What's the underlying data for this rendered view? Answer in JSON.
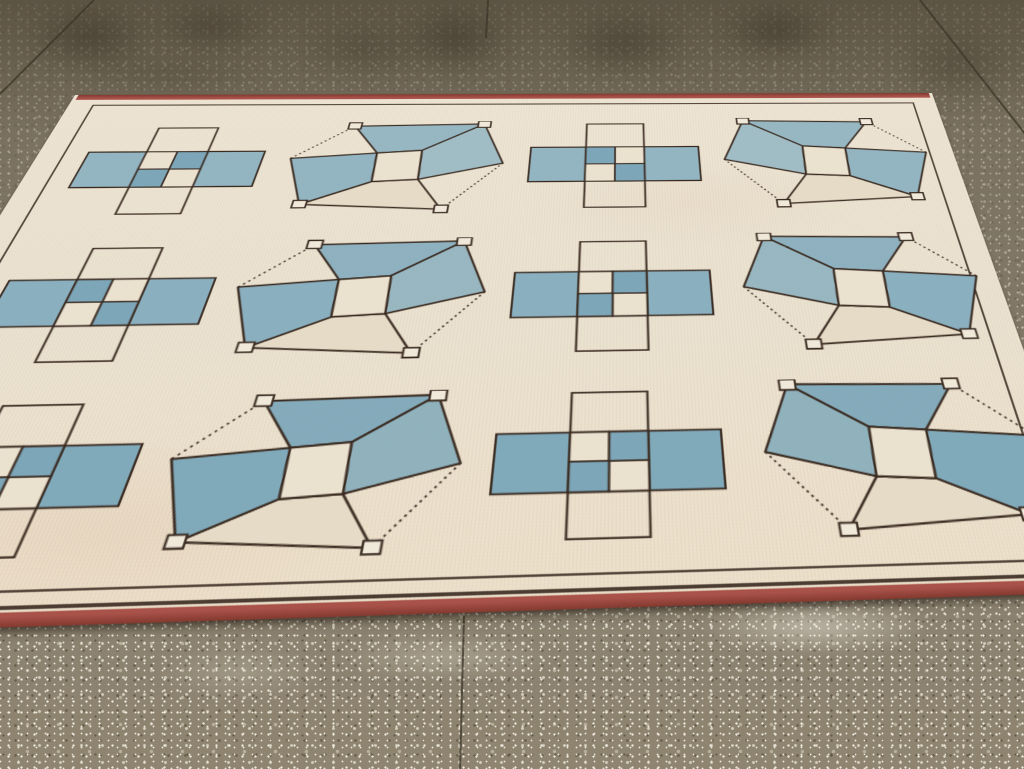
{
  "meta": {
    "type": "photograph",
    "subject": "Vintage cream rug with blue geometric cube and checkerboard motifs lying on a speckled concrete floor"
  },
  "palette": {
    "floor_top": "#6b6252",
    "floor_mid": "#857b69",
    "floor_bottom": "#8e846f",
    "joint": "#3c352a",
    "stain": "#383023",
    "shine": "#f4f0e4",
    "rug_cream_hi": "#ede4d3",
    "rug_cream": "#eae1cf",
    "rug_cream_lo": "#ecdfc9",
    "rug_cream_deep": "#e5dbc6",
    "outline": "#3a2b21",
    "selvage_red": "#a8524a",
    "selvage_red_dark": "#84392f",
    "white_square": "#f0e9da",
    "checker_blue_deep": "#7da6b8",
    "blue_row1": "#93b5c2",
    "blue_row2": "#8aafbe",
    "blue_row3": "#80a9ba"
  },
  "floor": {
    "stains": [
      {
        "x": 25,
        "y": 0,
        "w": 130,
        "h": 75,
        "o": 0.5
      },
      {
        "x": 150,
        "y": 0,
        "w": 120,
        "h": 55,
        "o": 0.42
      },
      {
        "x": 300,
        "y": 18,
        "w": 130,
        "h": 62,
        "o": 0.3
      },
      {
        "x": 398,
        "y": 0,
        "w": 115,
        "h": 78,
        "o": 0.5
      },
      {
        "x": 556,
        "y": 8,
        "w": 135,
        "h": 72,
        "o": 0.45
      },
      {
        "x": 716,
        "y": 0,
        "w": 120,
        "h": 62,
        "o": 0.5
      },
      {
        "x": 890,
        "y": 22,
        "w": 135,
        "h": 85,
        "o": 0.32
      },
      {
        "x": 70,
        "y": 52,
        "w": 200,
        "h": 46,
        "o": 0.22
      }
    ],
    "joints": [
      {
        "x1": 94,
        "y1": 0,
        "x2": 0,
        "y2": 94
      },
      {
        "x1": 488,
        "y1": 0,
        "x2": 486,
        "y2": 38
      },
      {
        "x1": 920,
        "y1": 0,
        "x2": 1026,
        "y2": 135
      },
      {
        "x1": 464,
        "y1": 616,
        "x2": 460,
        "y2": 770
      }
    ],
    "light_patches": [
      {
        "x": 695,
        "y": 598,
        "w": 240,
        "h": 58,
        "o": 0.45
      },
      {
        "x": 330,
        "y": 632,
        "w": 230,
        "h": 50,
        "o": 0.28
      },
      {
        "x": 150,
        "y": 642,
        "w": 180,
        "h": 60,
        "o": 0.2
      },
      {
        "x": 0,
        "y": 120,
        "w": 90,
        "h": 320,
        "o": 0.14
      }
    ]
  },
  "rug": {
    "grid": {
      "rows": 3,
      "cols": 4,
      "column_pattern": [
        "quincunx",
        "cube",
        "quincunx",
        "cube"
      ]
    },
    "motifs": [
      {
        "row": 1,
        "col": 1,
        "type": "quincunx",
        "checker": "b",
        "x": 50,
        "y": 58,
        "w": 190,
        "h": 140
      },
      {
        "row": 1,
        "col": 2,
        "type": "cube",
        "mirror": false,
        "x": 265,
        "y": 50,
        "w": 235,
        "h": 150
      },
      {
        "row": 1,
        "col": 3,
        "type": "quincunx",
        "checker": "a",
        "x": 524,
        "y": 54,
        "w": 190,
        "h": 140
      },
      {
        "row": 1,
        "col": 4,
        "type": "cube",
        "mirror": true,
        "x": 737,
        "y": 46,
        "w": 235,
        "h": 150
      },
      {
        "row": 2,
        "col": 1,
        "type": "quincunx",
        "checker": "a",
        "x": 44,
        "y": 242,
        "w": 195,
        "h": 142
      },
      {
        "row": 2,
        "col": 2,
        "type": "cube",
        "mirror": false,
        "x": 258,
        "y": 234,
        "w": 240,
        "h": 152
      },
      {
        "row": 2,
        "col": 3,
        "type": "quincunx",
        "checker": "b",
        "x": 520,
        "y": 240,
        "w": 195,
        "h": 142
      },
      {
        "row": 2,
        "col": 4,
        "type": "cube",
        "mirror": true,
        "x": 742,
        "y": 232,
        "w": 240,
        "h": 152
      },
      {
        "row": 3,
        "col": 1,
        "type": "quincunx",
        "checker": "b",
        "x": 36,
        "y": 426,
        "w": 195,
        "h": 142
      },
      {
        "row": 3,
        "col": 2,
        "type": "cube",
        "mirror": false,
        "x": 254,
        "y": 420,
        "w": 242,
        "h": 154
      },
      {
        "row": 3,
        "col": 3,
        "type": "quincunx",
        "checker": "b",
        "x": 518,
        "y": 424,
        "w": 195,
        "h": 142
      },
      {
        "row": 3,
        "col": 4,
        "type": "cube",
        "mirror": true,
        "x": 744,
        "y": 416,
        "w": 242,
        "h": 154
      }
    ]
  }
}
